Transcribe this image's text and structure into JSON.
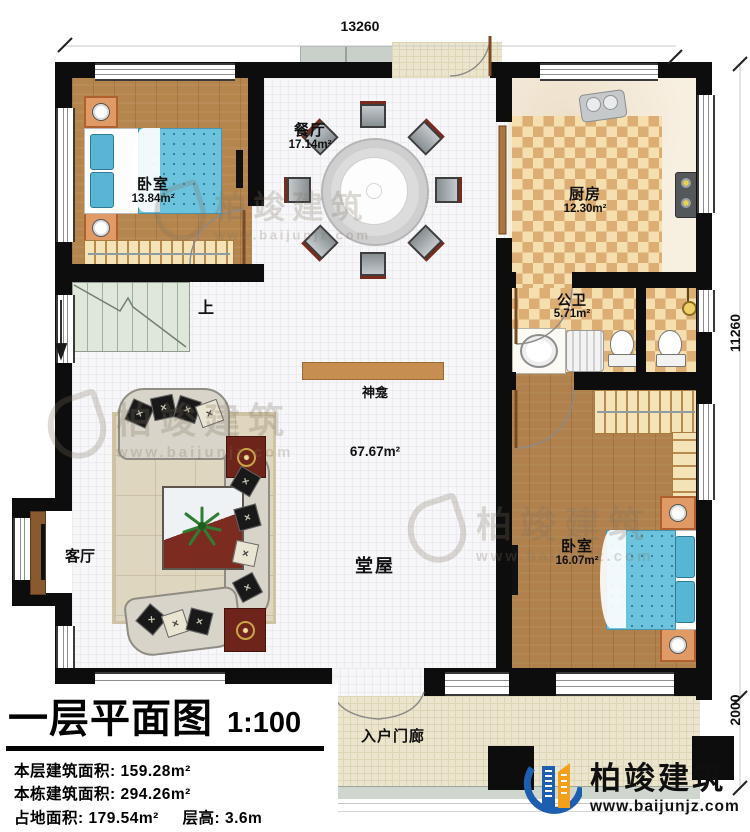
{
  "dimensions": {
    "top": "13260",
    "side": "11260",
    "porch": "2000"
  },
  "rooms": {
    "bedroom_tl": {
      "name": "卧室",
      "area": "13.84m²"
    },
    "dining": {
      "name": "餐厅",
      "area": "17.14m²"
    },
    "kitchen": {
      "name": "厨房",
      "area": "12.30m²"
    },
    "bathroom": {
      "name": "公卫",
      "area": "5.71m²"
    },
    "bedroom_r": {
      "name": "卧室",
      "area": "16.07m²"
    },
    "hall": {
      "name": "堂屋",
      "area": "67.67m²"
    },
    "living": {
      "name": "客厅"
    },
    "shrine": {
      "name": "神龛"
    },
    "entry_porch": {
      "name": "入户门廊"
    },
    "stairs": {
      "direction_label": "上"
    }
  },
  "legend": {
    "title": "一层平面图",
    "scale": "1:100",
    "floor_area_label": "本层建筑面积:",
    "floor_area_value": "159.28m²",
    "building_area_label": "本栋建筑面积:",
    "building_area_value": "294.26m²",
    "footprint_label": "占地面积:",
    "footprint_value": "179.54m²",
    "height_label": "层高:",
    "height_value": "3.6m"
  },
  "brand": {
    "name": "柏竣建筑",
    "website": "www.baijunjz.com"
  },
  "watermark": {
    "name": "柏竣建筑",
    "website": "www.baijunjz.com"
  }
}
